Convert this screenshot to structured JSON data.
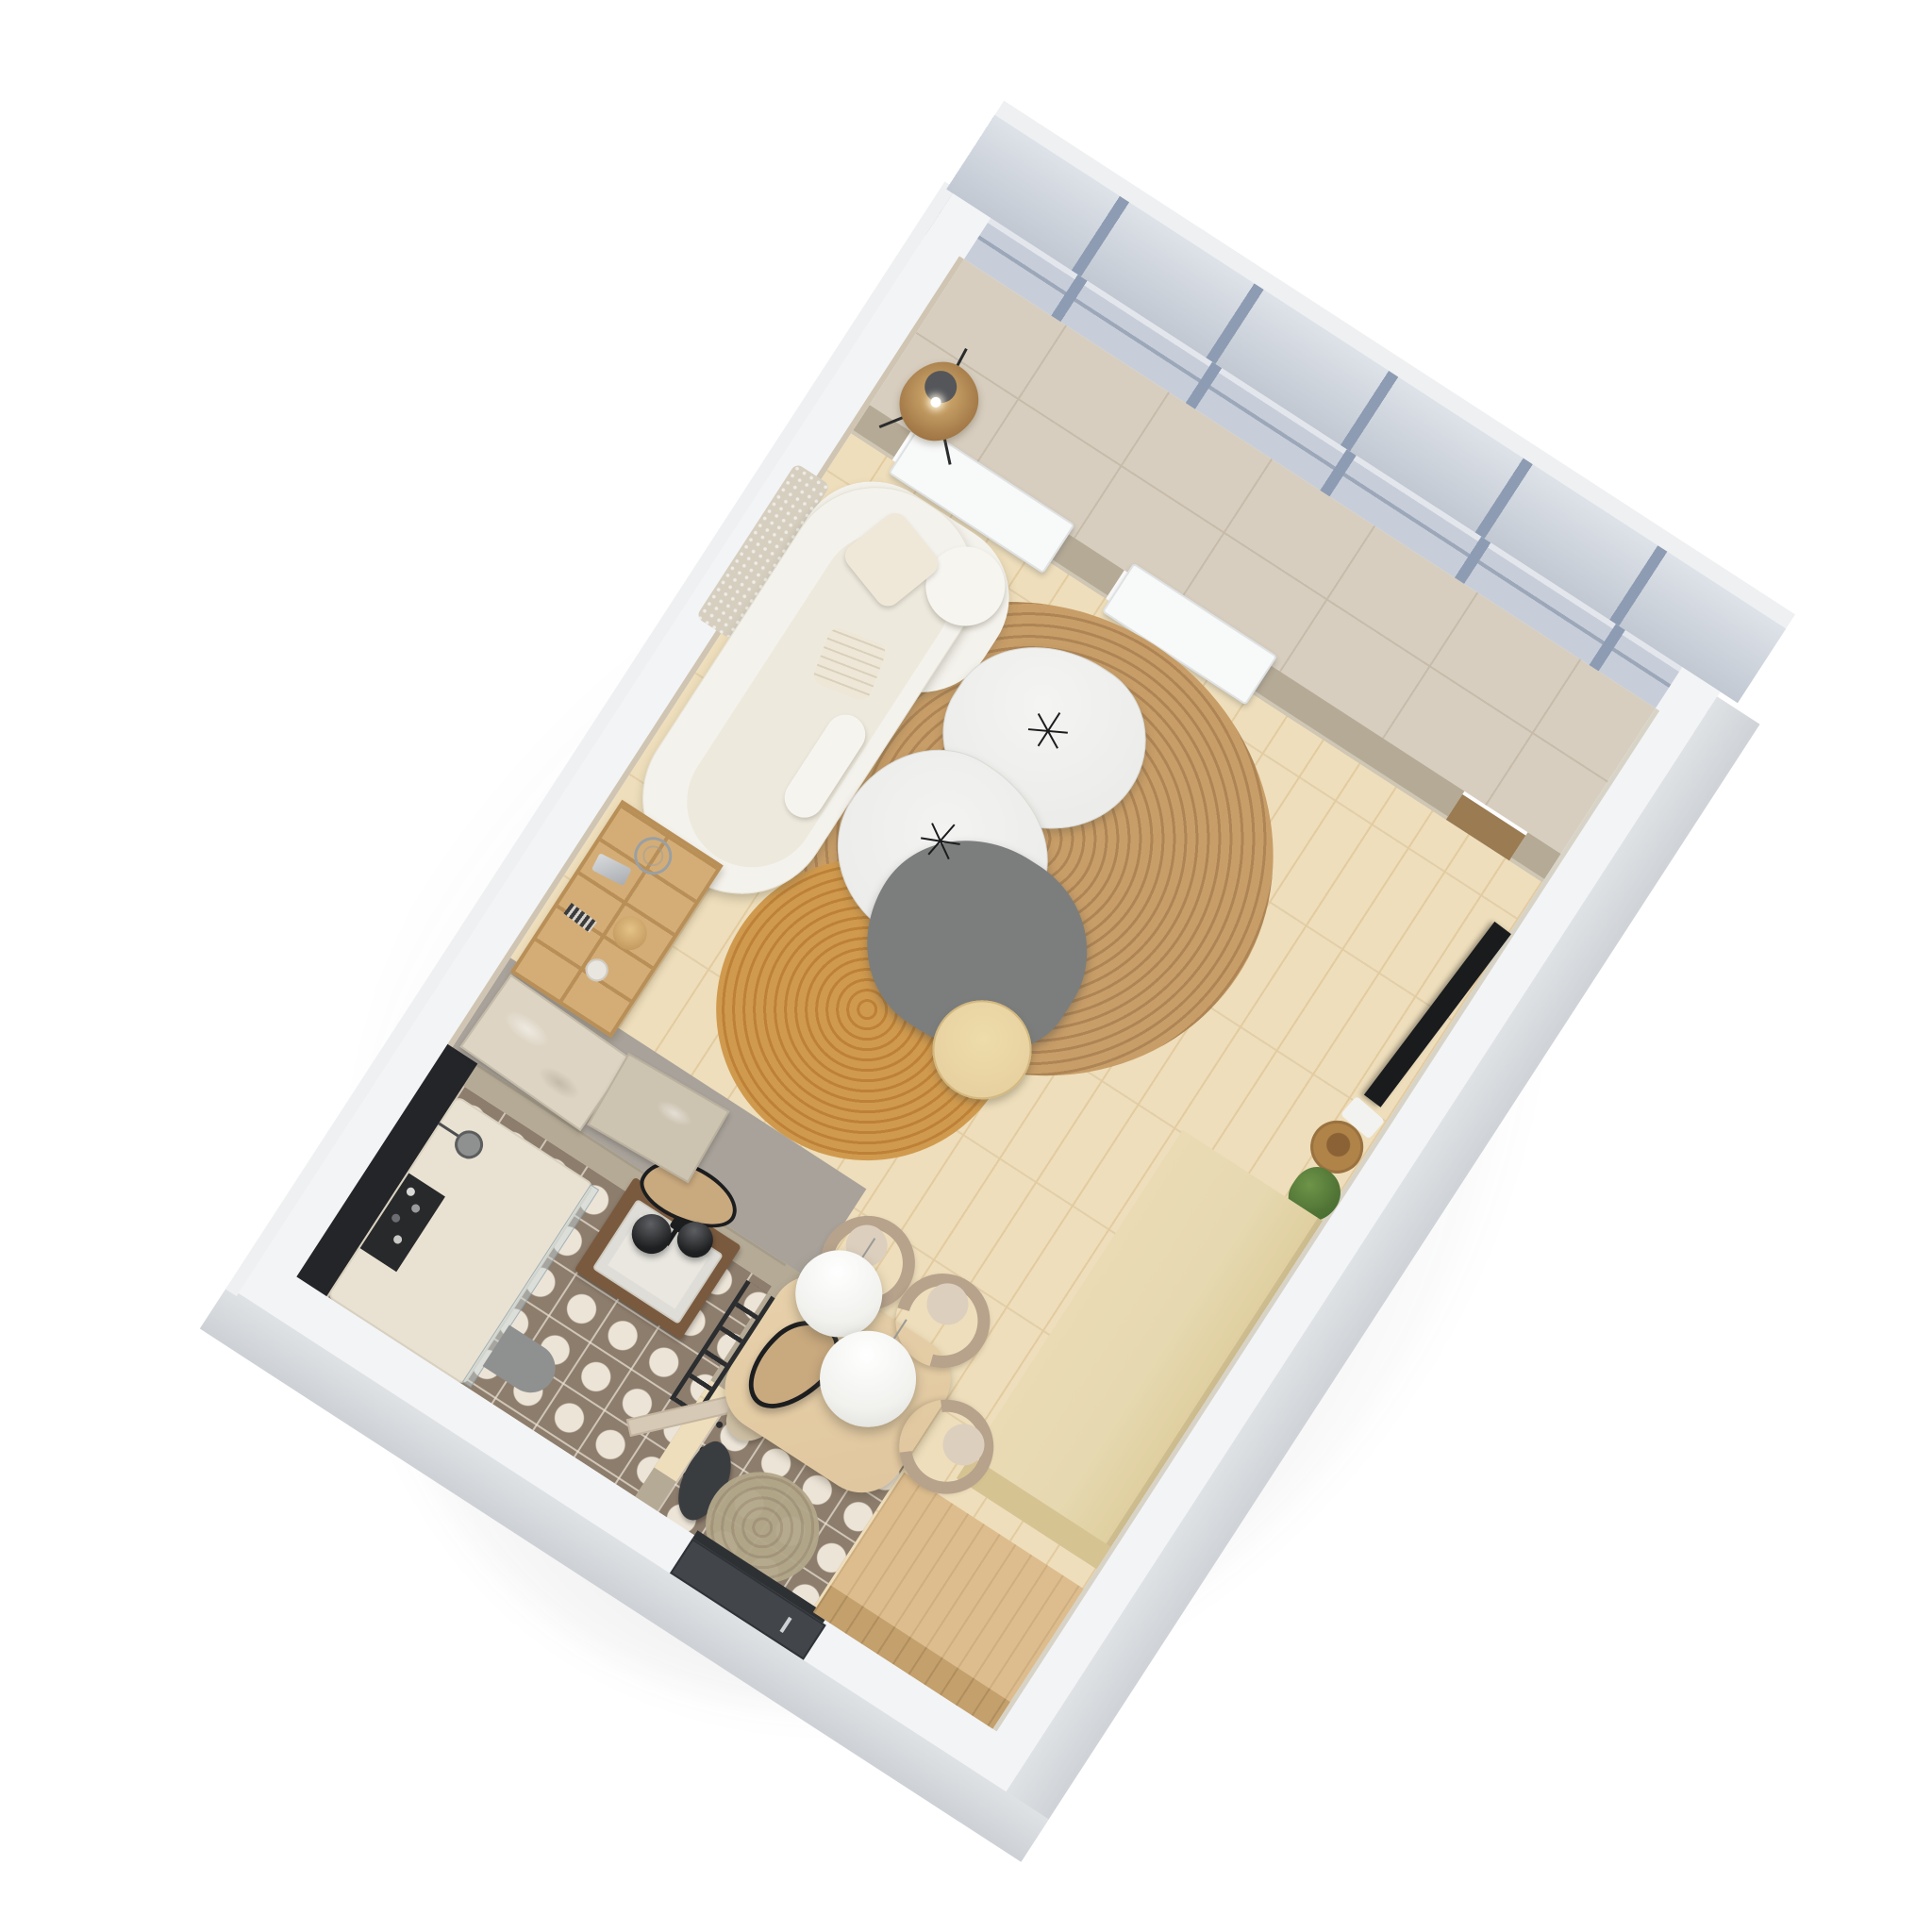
{
  "meta": {
    "type": "3d-floorplan-render",
    "view": "isometric top-down cutaway",
    "description": "Photorealistic isometric 3D render of a studio apartment floor plan in white, beige and oak tones, rotated diagonally on a white background",
    "rotation_deg": 33
  },
  "palette": {
    "bg": "#ffffff",
    "band": "#f3f4f6",
    "band-outer": "#dfe2e5",
    "wall-inner": "#cfc5b2",
    "glass": "#c7ced9",
    "glass-ext": "#ccd3dd",
    "mullion": "#8d9cb3",
    "tile": "#d7cebf",
    "grout": "#c7bcab",
    "partition": "#b5aa96",
    "partition-light": "#cfc6b4",
    "radiator": "#f8f9f9",
    "radiator-edge": "#dfe2e3",
    "step": "#9a7b52",
    "parquet": "#eedebb",
    "parquet-col": "#e3cba0",
    "concrete": "#a8a29a",
    "sofa": "#f4f2ec",
    "sofa-inner": "#e7e2d4",
    "cushion": "#efe8d9",
    "macrame": "#d6cfc0",
    "rug-big": "#c69a63",
    "rug-big-2": "#ab8050",
    "rug-small": "#d09a4e",
    "rug-small-2": "#bd8137",
    "marble": "#ececea",
    "marble-edge": "#d9d9d6",
    "tbl-gray": "#7c7e7d",
    "stool": "#e5cc9b",
    "shelfwood": "#d4ad76",
    "shelfwood-2": "#b98f58",
    "canvas-a": "#ddd4c3",
    "canvas-b": "#cdc3b1",
    "tv": "#191b1d",
    "plant": "#517436",
    "basket": "#b08349",
    "blk1": "#e6d8b0",
    "blk1-side": "#d6c392",
    "blk2": "#ddbd8e",
    "blk2-side": "#c3a06c",
    "chair": "#b7a28c",
    "chair-seat": "#dccfbe",
    "dine": "#e0c69e",
    "pendant": "#f1f1ee",
    "pendant-edge": "#d8d8d3",
    "black": "#232528",
    "bathfloor": "#8d7d6d",
    "bathdot": "#ece4d7",
    "tray": "#e9e2d2",
    "matgray": "#8f9190",
    "door-dark": "#42464a",
    "door-handle": "#cfd2d4",
    "door-beige": "#d6c9b6",
    "jute": "#b3a78a",
    "bag": "#cdbfa4",
    "coat": "#3a3d40",
    "mirror-frame": "#1c1d1f",
    "mirror-fill": "#c9a97e",
    "vanity": "#7a5a3e",
    "sink": "#e9e7e0",
    "lamp": "#d8b274",
    "lamp-dark": "#8a5f33"
  },
  "rooms": [
    {
      "name": "living-room",
      "floor": "light oak parquet"
    },
    {
      "name": "dining-area",
      "floor": "light oak parquet"
    },
    {
      "name": "kitchen-run",
      "floor": "light oak parquet"
    },
    {
      "name": "bathroom",
      "floor": "taupe tile with white circle pattern"
    },
    {
      "name": "entry-hall",
      "floor": "taupe tile with white circle pattern"
    },
    {
      "name": "window-gallery",
      "floor": "beige ceramic tile"
    }
  ],
  "labels": {
    "apartment": "Studio apartment 3D floor plan",
    "glazing": "Full-height glazed facade with grey mullions",
    "radiators": "White radiator panels under window openings",
    "floorlamp": "Rattan tripod floor lamp",
    "macrame": "Macrame wall hanging",
    "sofa": "Curved white boucle sofa with cushions",
    "rugbig": "Large round jute rug",
    "rugsmall": "Small round jute rug",
    "ctwhite": "Organic white marble coffee table",
    "ctgray": "Organic grey coffee table",
    "stool": "Round wooden side table",
    "candelabra": "Black wire candle holder",
    "shelf": "Oak ladder shelving unit with decor",
    "canvases": "Abstract relief canvases leaning on concrete wall",
    "tv": "Flat TV leaning against wall",
    "basket": "Wicker basket",
    "plant": "Potted green plant",
    "block1": "Pale oak kitchen counter block",
    "block2": "Oak wardrobe / tall cabinet block",
    "diningtable": "Oak dining table",
    "chair": "Curved taupe dining chair",
    "pendant": "White sphere pendant lamp",
    "hallmirror": "Organic black-framed mirror",
    "blackwall": "Black accent wall",
    "shower": "Walk-in shower with glass screen",
    "showerhead": "Rain shower head",
    "toiletries": "Black toiletry shelf with bottles",
    "vanity": "Walnut vanity with stone sink",
    "bathmirror": "Organic bathroom mirror",
    "bathpendant": "Black globe pendant",
    "ladder": "Black towel ladder",
    "bathmat": "Grey half-round bath mat",
    "bathdoor": "Open beige bathroom door",
    "hooks": "Entry coat hooks with bag and coats",
    "jutemat": "Round jute doormat",
    "entrydoor": "Dark entry door with handle"
  }
}
